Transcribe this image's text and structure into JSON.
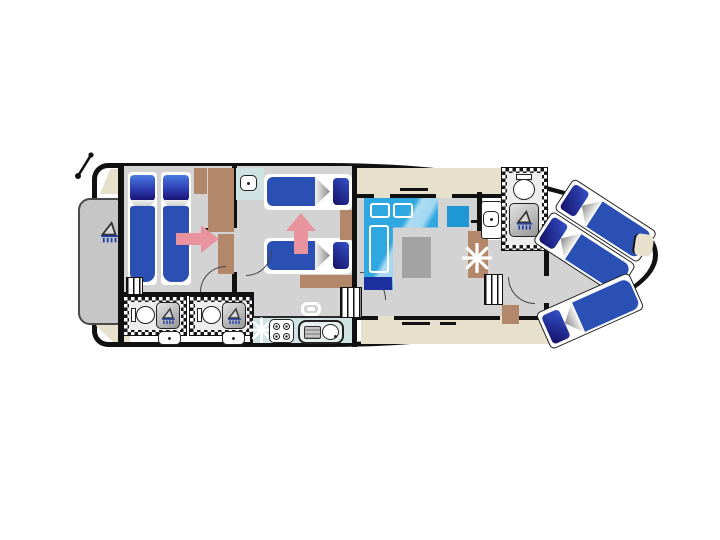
{
  "meta": {
    "type": "boat-deck-plan",
    "description": "Top-down floor plan of a river cruiser boat, bow pointing right",
    "berth_count": 7
  },
  "colors": {
    "hull": "#111111",
    "floor": "#d3d3d3",
    "platform": "#c6c6c6",
    "beige": "#e6e0cd",
    "brown": "#b2876a",
    "bed": "#2a50b4",
    "sofa": "#2fa7e0",
    "sofa-dark": "#1b2f9e",
    "chair": "#1e97d4",
    "teal": "#cfe3e3",
    "pink": "#e8939e",
    "table": "#a3a3a3",
    "spray": "#1d3fae"
  },
  "rooms": {
    "stern_deck": {
      "label": "Stern deck with swim platform",
      "items": [
        "swim-platform",
        "deck-shower",
        "mast"
      ]
    },
    "aft_cabin": {
      "label": "Aft cabin with two single beds",
      "items": [
        "single-bed",
        "single-bed",
        "wardrobe",
        "steps",
        "conversion-arrow"
      ]
    },
    "bathroom_port": {
      "label": "Bathroom 1",
      "items": [
        "toilet",
        "shower",
        "washbasin"
      ]
    },
    "bathroom_mid": {
      "label": "Bathroom 2",
      "items": [
        "toilet",
        "shower",
        "washbasin"
      ]
    },
    "middle_cabin": {
      "label": "Middle cabin with two single beds",
      "items": [
        "single-bed",
        "single-bed",
        "washbasin",
        "wardrobe",
        "dresser",
        "conversion-arrow"
      ]
    },
    "galley": {
      "label": "Galley",
      "items": [
        "hob-4-burners",
        "sink-with-drainer",
        "worktop",
        "ceiling-hatch",
        "star-marker"
      ]
    },
    "saloon": {
      "label": "Saloon",
      "items": [
        "l-shaped-convertible-sofa",
        "table",
        "chair",
        "helm-star",
        "steps",
        "side-deck-windows"
      ]
    },
    "bow_bathroom": {
      "label": "Bow bathroom",
      "items": [
        "toilet",
        "shower",
        "washbasin"
      ]
    },
    "bow_cabin": {
      "label": "Bow cabin",
      "items": [
        "double-bed",
        "single-bed",
        "bow-seat"
      ]
    }
  }
}
